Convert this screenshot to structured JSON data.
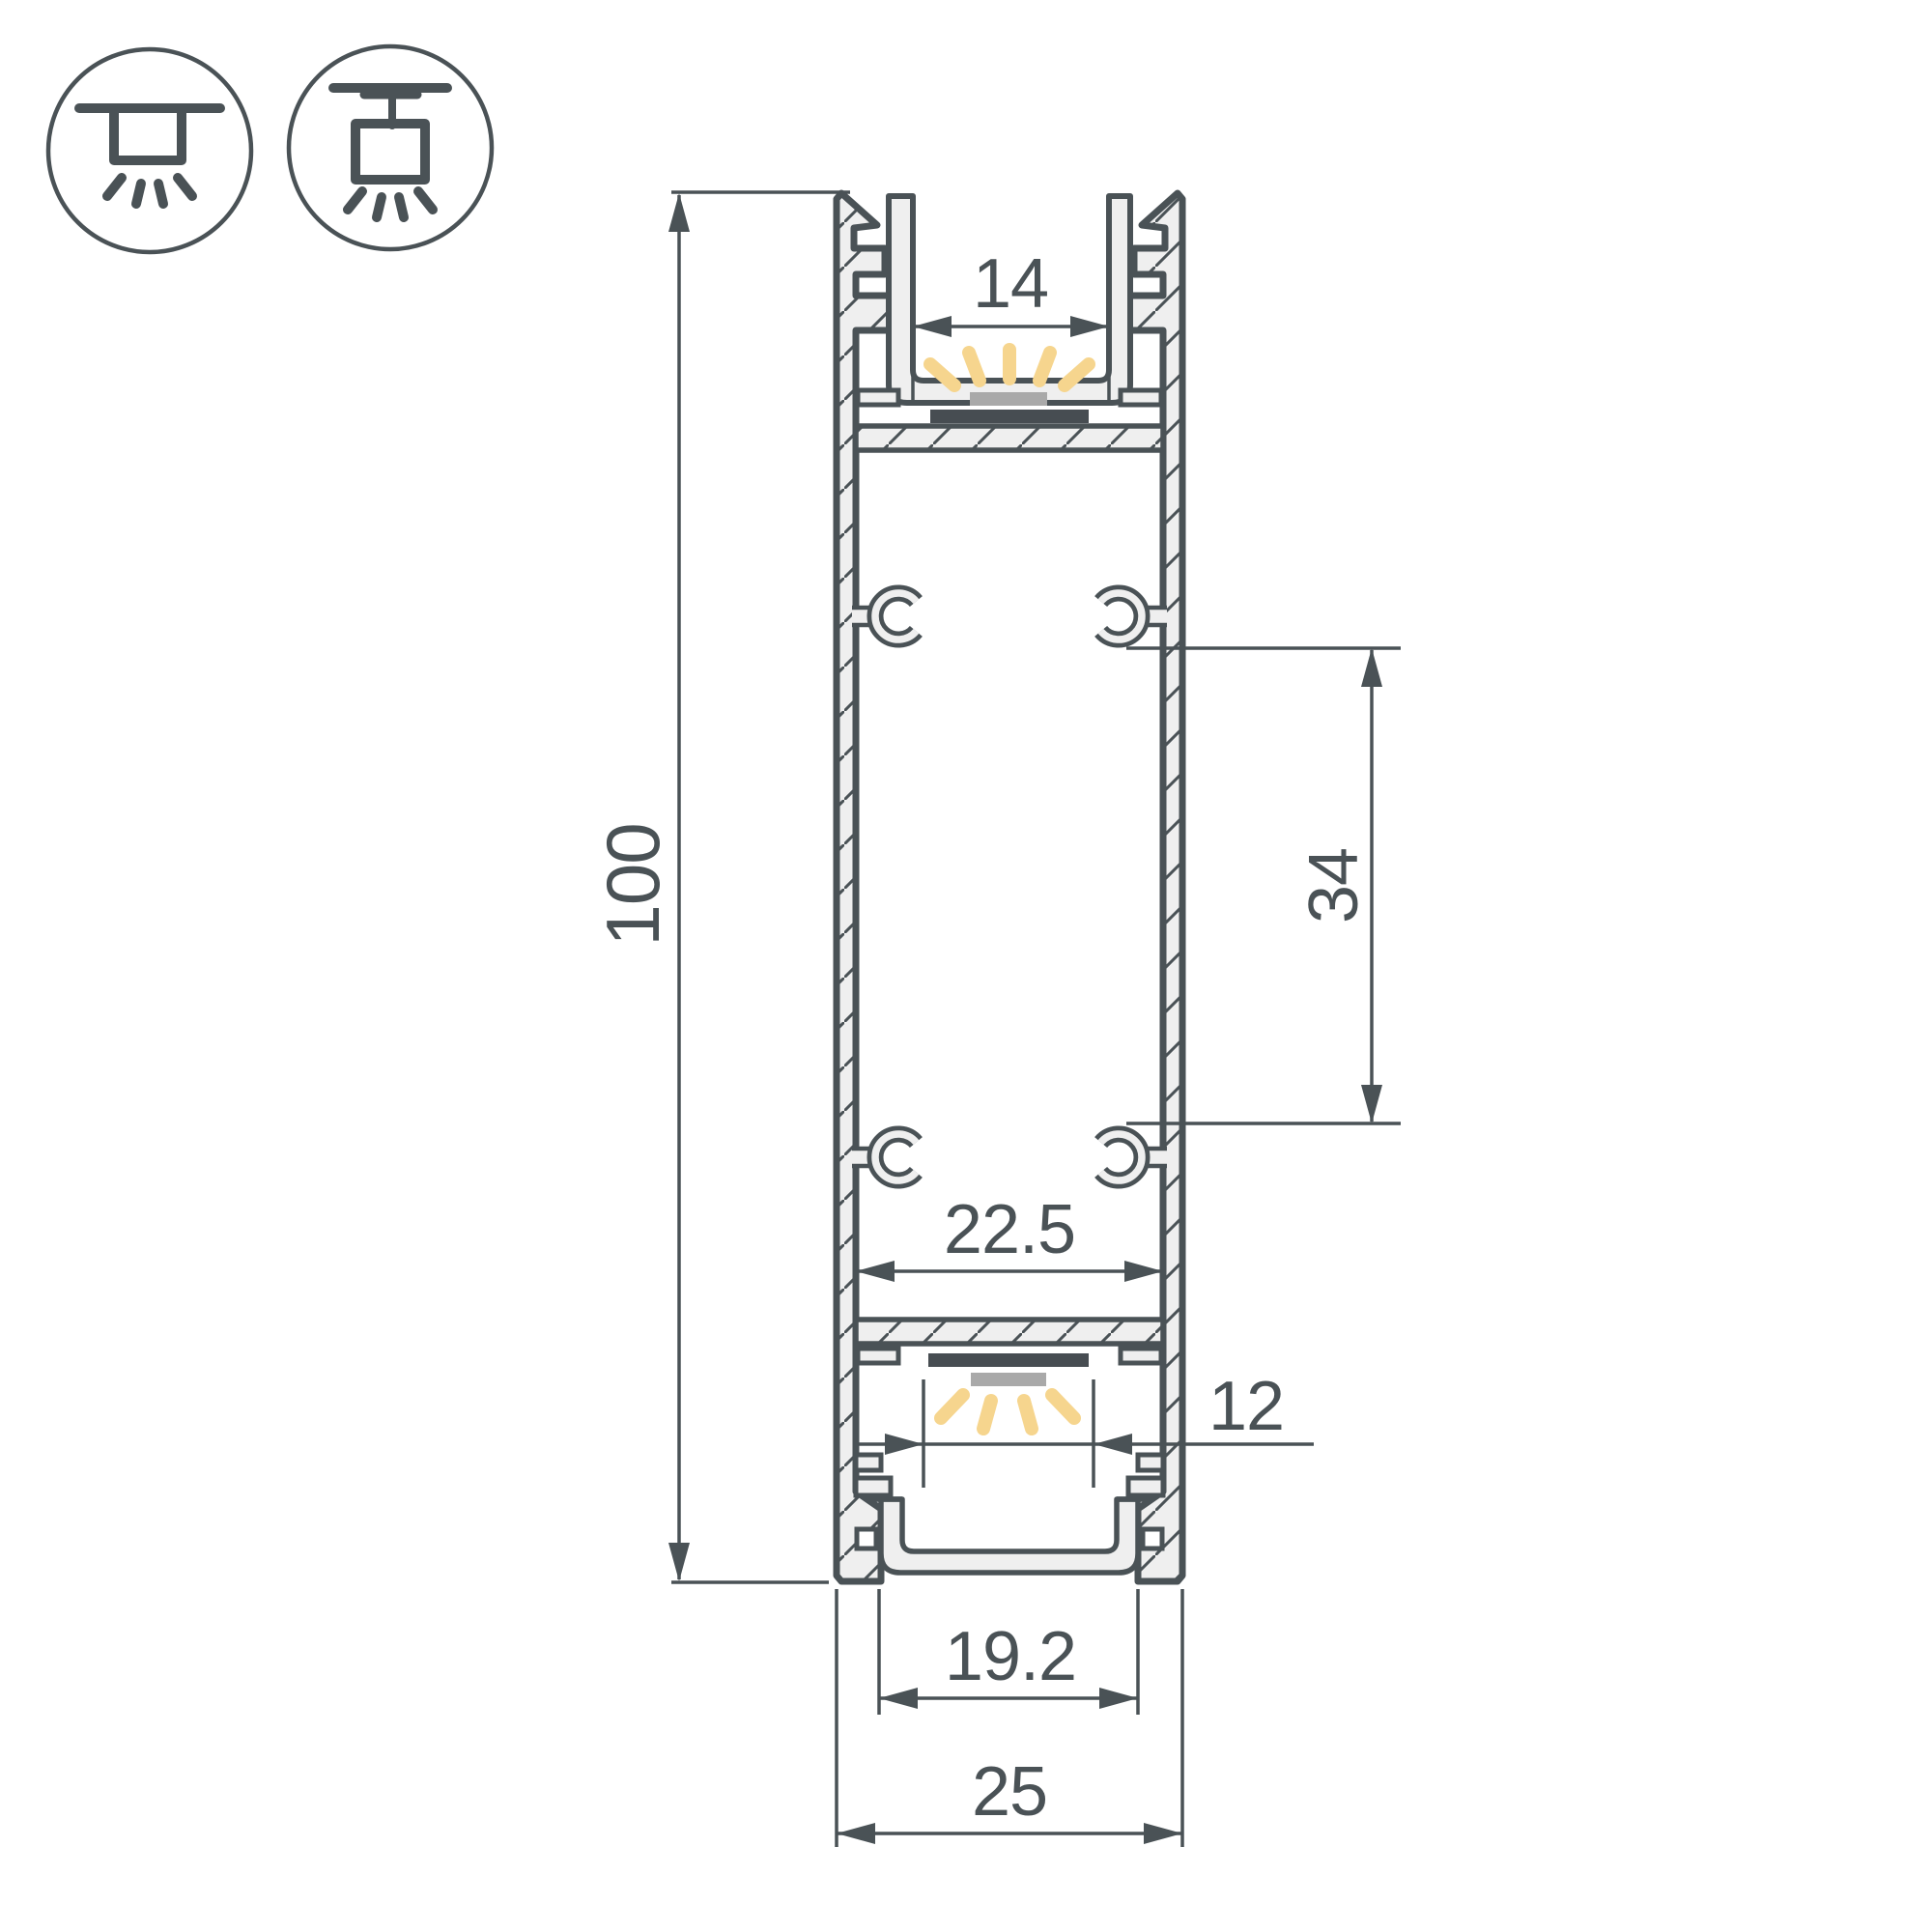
{
  "colors": {
    "line": "#4a5256",
    "aluminum_fill": "#efefef",
    "led_glow": "#f6d58e",
    "led_module": "#a9a9a9",
    "led_strip_pcb": "#474d52",
    "background": "#ffffff"
  },
  "legend_icons": {
    "first": "recessed-ceiling-mount-light",
    "second": "surface-ceiling-mount-light"
  },
  "dimensions": {
    "overall_height": "100",
    "top_window_width": "14",
    "fixing_channel_spacing": "34",
    "inner_cavity_width": "22.5",
    "bottom_window_width": "12",
    "bottom_opening_width": "19.2",
    "overall_width": "25"
  }
}
